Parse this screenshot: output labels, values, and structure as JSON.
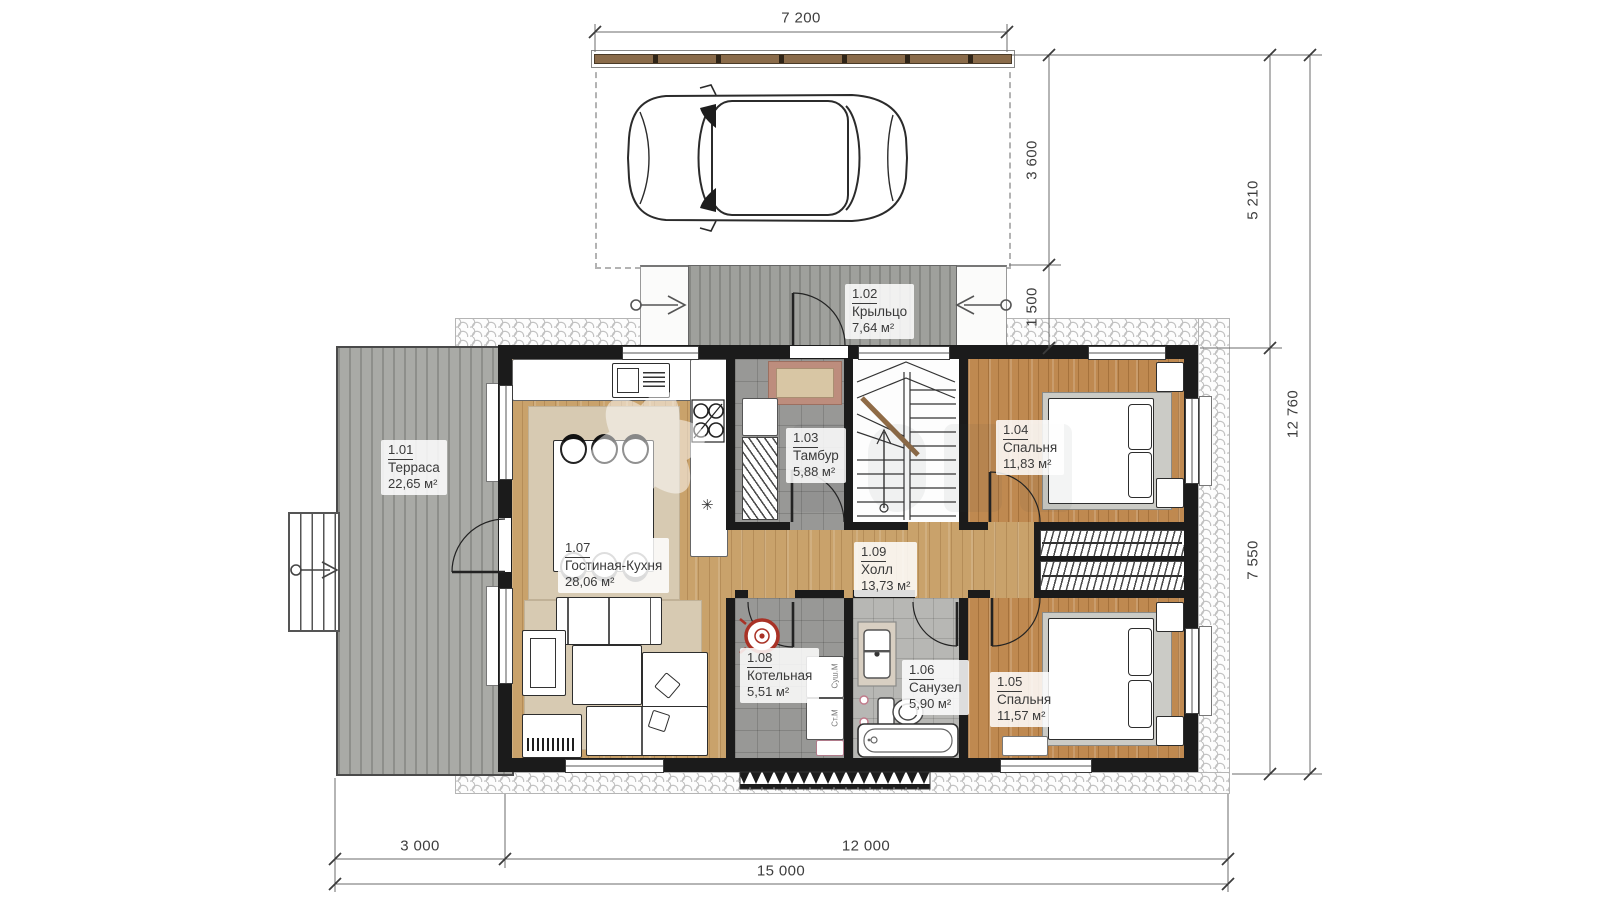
{
  "dims": {
    "top_width": "7 200",
    "parking_depth": "3 600",
    "porch_depth": "1 500",
    "right_upper": "5 210",
    "right_house": "7 550",
    "right_total": "12 760",
    "bottom_terrace": "3 000",
    "bottom_house": "12 000",
    "bottom_total": "15 000"
  },
  "rooms": [
    {
      "num": "1.01",
      "name": "Терраса",
      "area": "22,65 м²"
    },
    {
      "num": "1.02",
      "name": "Крыльцо",
      "area": "7,64 м²"
    },
    {
      "num": "1.03",
      "name": "Тамбур",
      "area": "5,88 м²"
    },
    {
      "num": "1.04",
      "name": "Спальня",
      "area": "11,83 м²"
    },
    {
      "num": "1.05",
      "name": "Спальня",
      "area": "11,57 м²"
    },
    {
      "num": "1.06",
      "name": "Санузел",
      "area": "5,90 м²"
    },
    {
      "num": "1.07",
      "name": "Гостиная-Кухня",
      "area": "28,06 м²"
    },
    {
      "num": "1.08",
      "name": "Котельная",
      "area": "5,51 м²"
    },
    {
      "num": "1.09",
      "name": "Холл",
      "area": "13,73 м²"
    }
  ],
  "appliances": {
    "dryer": "Суш.М",
    "washer": "Ст.М"
  },
  "icons": {
    "snowflake_glyph": "✳"
  },
  "colors": {
    "wood_light": "#c9a26b",
    "wood_dark": "#bf8950",
    "deck_gray": "#a9aaa6",
    "tile_gray": "#989896",
    "wall": "#1b1b1b",
    "boiler_red": "#a93226"
  }
}
